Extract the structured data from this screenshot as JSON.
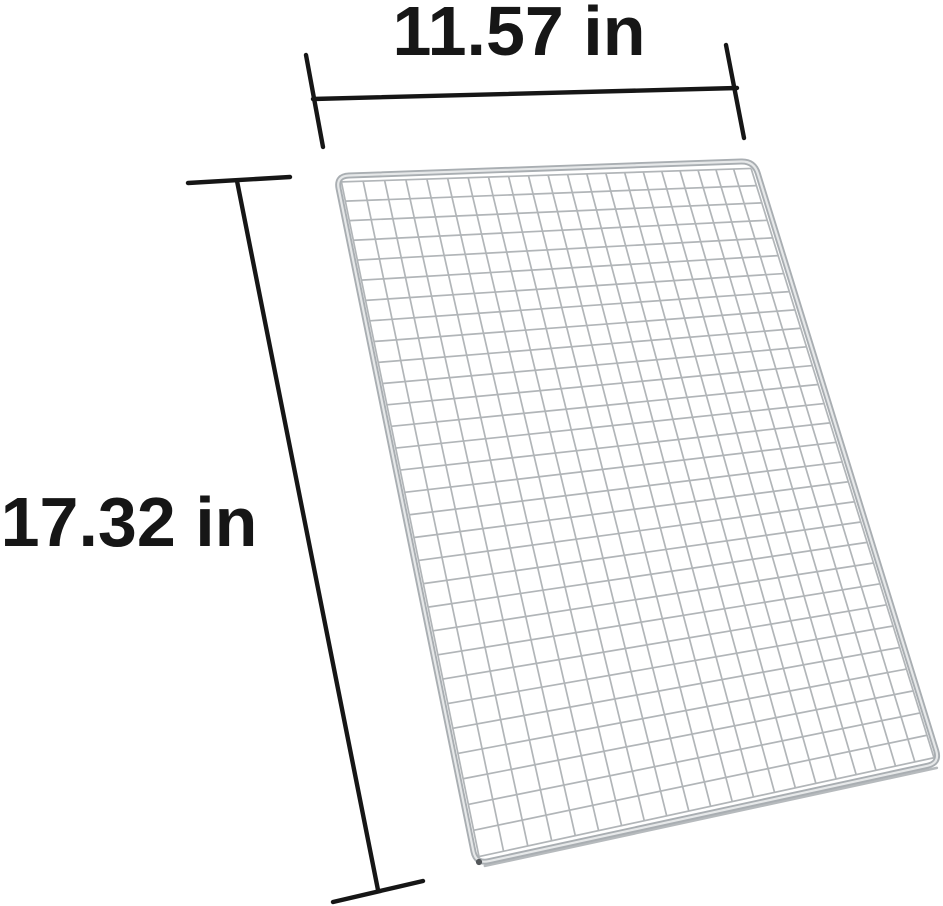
{
  "diagram": {
    "description": "wire-mesh-grill-grate-dimension-diagram",
    "width_dim": {
      "label": "11.57 in",
      "value": 11.57,
      "unit": "in"
    },
    "height_dim": {
      "label": "17.32 in",
      "value": 17.32,
      "unit": "in"
    },
    "background": "#ffffff",
    "mesh": {
      "columns": 21,
      "rows": 30,
      "corners": {
        "top_left": [
          336,
          176
        ],
        "top_right": [
          754,
          161
        ],
        "bottom_right": [
          940,
          763
        ],
        "bottom_left": [
          476,
          864
        ]
      },
      "corner_radius": 13,
      "inset": 8,
      "wire_color": "#b1b5b8",
      "frame_color": "#a9aeb2",
      "frame_highlight": "#e6e8e9",
      "frame_shadow": "#b6babd",
      "corner_dot_color": "#53575a"
    },
    "annotation": {
      "color": "#161616",
      "stroke_width": 4.4,
      "font_size": 70,
      "width_line": {
        "x1": 313,
        "y1": 99,
        "x2": 737,
        "y2": 88,
        "tick1": [
          306,
          55,
          323,
          147
        ],
        "tick2": [
          726,
          45,
          744,
          138
        ],
        "label_anchor": [
          519,
          55
        ]
      },
      "height_line": {
        "x1": 237,
        "y1": 181,
        "x2": 378,
        "y2": 890,
        "tick1": [
          188,
          183,
          290,
          177
        ],
        "tick2": [
          333,
          902,
          423,
          881
        ],
        "label_anchor": [
          129,
          546
        ]
      }
    }
  }
}
